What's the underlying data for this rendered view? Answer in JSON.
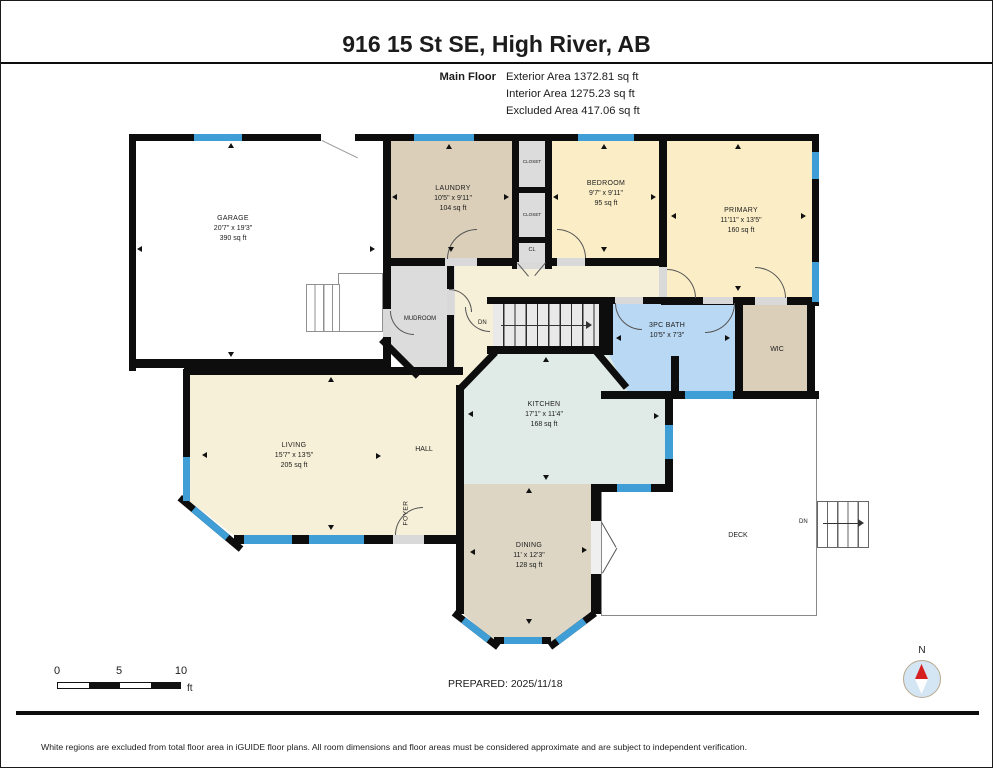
{
  "header": {
    "title": "916 15 St SE, High River, AB",
    "floor_label": "Main Floor",
    "exterior": "Exterior Area 1372.81 sq ft",
    "interior": "Interior Area 1275.23 sq ft",
    "excluded": "Excluded Area 417.06 sq ft"
  },
  "rooms": {
    "garage": {
      "name": "GARAGE",
      "dims": "20'7\" x 19'3\"",
      "area": "390 sq ft"
    },
    "laundry": {
      "name": "LAUNDRY",
      "dims": "10'5\" x 9'11\"",
      "area": "104 sq ft"
    },
    "bedroom": {
      "name": "BEDROOM",
      "dims": "9'7\" x 9'11\"",
      "area": "95 sq ft"
    },
    "primary": {
      "name": "PRIMARY",
      "dims": "11'11\" x 13'5\"",
      "area": "160 sq ft"
    },
    "kitchen": {
      "name": "KITCHEN",
      "dims": "17'1\" x 11'4\"",
      "area": "168 sq ft"
    },
    "living": {
      "name": "LIVING",
      "dims": "15'7\" x 13'5\"",
      "area": "205 sq ft"
    },
    "dining": {
      "name": "DINING",
      "dims": "11' x 12'3\"",
      "area": "128 sq ft"
    },
    "bath": {
      "name": "3PC BATH",
      "dims": "10'5\" x 7'3\""
    },
    "mudroom": {
      "name": "MUDROOM"
    },
    "hall": {
      "name": "HALL"
    },
    "foyer": {
      "name": "FOYER"
    },
    "deck": {
      "name": "DECK"
    },
    "wic": {
      "name": "WIC"
    },
    "closet_top": {
      "name": "CLOSET"
    },
    "closet_mid": {
      "name": "CLOSET"
    },
    "cl": {
      "name": "CL"
    },
    "stairs_main": {
      "label": "DN"
    },
    "stairs_deck": {
      "label": "DN"
    }
  },
  "scale_bar": {
    "t0": "0",
    "t5": "5",
    "t10": "10",
    "unit": "ft"
  },
  "prepared": "PREPARED: 2025/11/18",
  "compass": {
    "label": "N"
  },
  "footer": "White regions are excluded from total floor area in iGUIDE floor plans. All room dimensions and floor areas must be considered approximate and are subject to independent verification.",
  "palette": {
    "wall": "#0d0d0d",
    "window_blue": "#3f9ed6",
    "bath_blue": "#b9d8f3",
    "kitchen_teal": "#e0ebe7",
    "bedroom_yellow": "#fbeec7",
    "living_cream": "#f7f0d8",
    "laundry_tan": "#dbcfb9",
    "dining_tan": "#ddd6c5",
    "mudroom_gray": "#dcdcdc",
    "compass_red": "#d62020"
  }
}
